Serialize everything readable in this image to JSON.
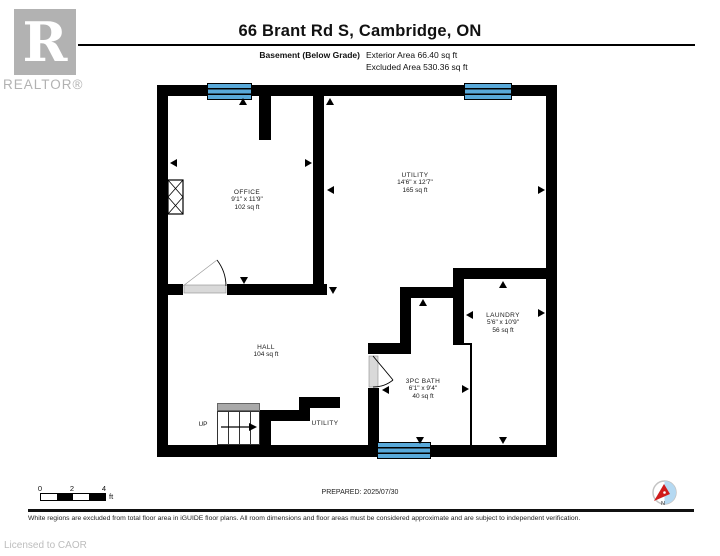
{
  "header": {
    "brand_letter": "R",
    "brand_name": "REALTOR®",
    "title": "66 Brant Rd S, Cambridge, ON",
    "floor_label": "Basement (Below Grade)",
    "exterior_area": "Exterior Area 66.40 sq ft",
    "excluded_area": "Excluded Area 530.36 sq ft"
  },
  "rooms": {
    "office": {
      "name": "OFFICE",
      "dims": "9'1\" x 11'9\"",
      "area": "102 sq ft"
    },
    "utility": {
      "name": "UTILITY",
      "dims": "14'6\" x 12'7\"",
      "area": "165 sq ft"
    },
    "hall": {
      "name": "HALL",
      "area": "104 sq ft"
    },
    "laundry": {
      "name": "LAUNDRY",
      "dims": "5'6\" x 10'9\"",
      "area": "56 sq ft"
    },
    "bath": {
      "name": "3PC BATH",
      "dims": "6'1\" x 9'4\"",
      "area": "40 sq ft"
    },
    "stairs": {
      "label": "UP"
    },
    "utility_closet": {
      "name": "UTILITY"
    }
  },
  "scale_bar": {
    "tick0": "0",
    "tick2": "2",
    "tick4": "4",
    "unit": "ft"
  },
  "footer": {
    "prepared": "PREPARED: 2025/07/30",
    "compass_label": "N",
    "disclaimer": "White regions are excluded from total floor area in iGUIDE floor plans. All room dimensions and floor areas must be considered approximate and are subject to independent verification.",
    "license": "Licensed to CAOR"
  },
  "colors": {
    "window_blue": "#59a9d9",
    "wall_black": "#000000",
    "door_gray": "#d9d9d9",
    "stair_gray": "#a9a9a9",
    "compass_blue": "#b5d9f2",
    "compass_red": "#cf1b1b"
  }
}
